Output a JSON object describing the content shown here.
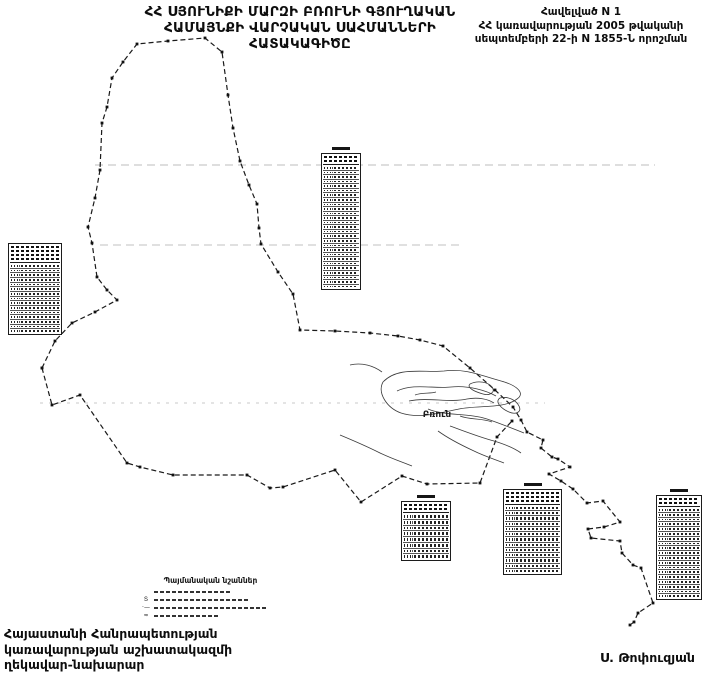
{
  "header": {
    "title_lines": [
      "ՀՀ ՍՅՈՒՆԻՔԻ ՄԱՐԶԻ ԲՌՈՒՆԻ ԳՅՈՒՂԱԿԱՆ",
      "ՀԱՄԱՅՆՔԻ ՎԱՐՉԱԿԱՆ  ՍԱՀՄԱՆՆԵՐԻ",
      "ՀԱՏԱԿԱԳԻԾԸ"
    ],
    "appendix_lines": [
      "Հավելված N 1",
      "ՀՀ կառավարության 2005 թվականի",
      "սեպտեմբերի 22-ի N 1855-Ն որոշման"
    ]
  },
  "map": {
    "settlement_label": "Բռուն",
    "legend": {
      "title": "Պայմանական նշաններ",
      "item_count": 4,
      "item_widths": [
        78,
        96,
        112,
        64
      ],
      "item_symbols": [
        "",
        "Տ",
        "·—",
        "≈"
      ]
    },
    "tables": [
      {
        "id": "t-left",
        "rows": 15,
        "header_lines": 4,
        "title_above": false
      },
      {
        "id": "t-top",
        "rows": 27,
        "header_lines": 2,
        "title_above": true
      },
      {
        "id": "t-b1",
        "rows": 8,
        "header_lines": 2,
        "title_above": true
      },
      {
        "id": "t-b2",
        "rows": 13,
        "header_lines": 3,
        "title_above": true
      },
      {
        "id": "t-b3",
        "rows": 19,
        "header_lines": 2,
        "title_above": true
      }
    ]
  },
  "footer": {
    "office_lines": [
      "Հայաստանի Հանրապետության",
      "կառավարության աշխատակազմի",
      "ղեկավար-նախարար"
    ],
    "signature": "Ս. Թոփուզյան"
  }
}
